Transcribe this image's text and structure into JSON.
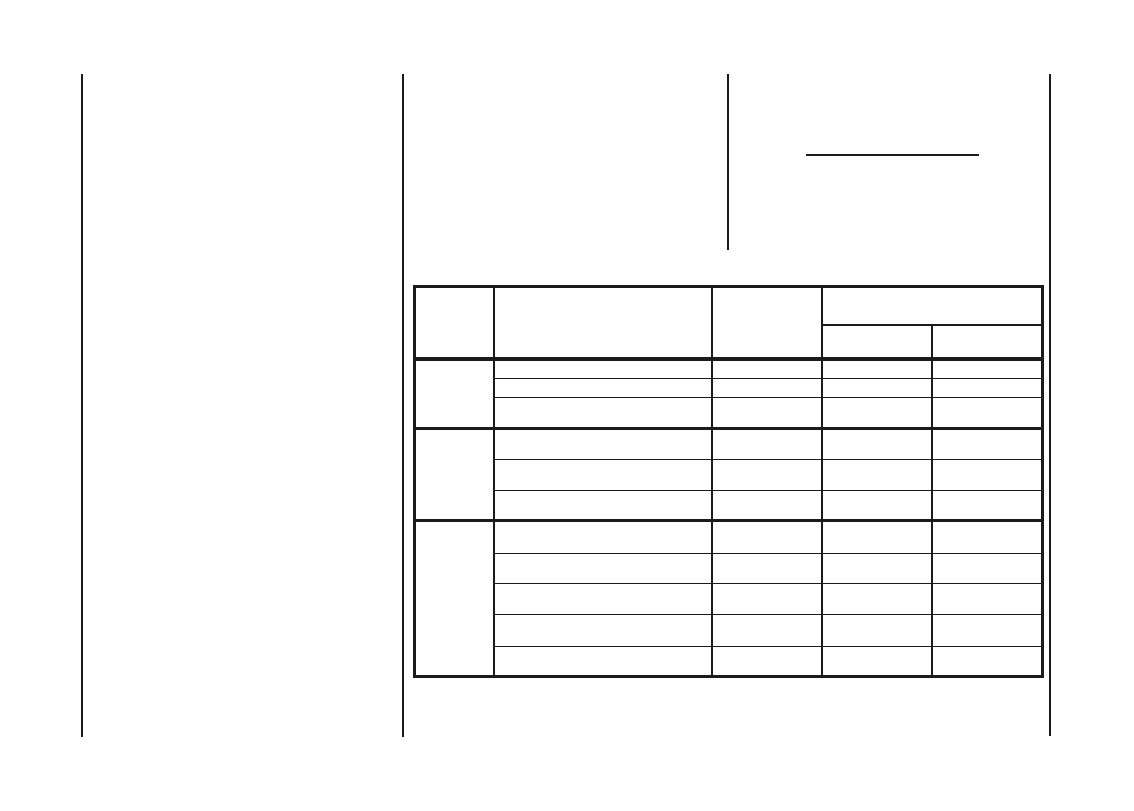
{
  "colors": {
    "background": "#ffffff",
    "ink": "#1d1a1b"
  },
  "blank_line": {
    "text": ""
  },
  "table": {
    "header": {
      "col1": "",
      "col2": "",
      "col3": "",
      "col4_group": "",
      "col4_sub1": "",
      "col4_sub2": ""
    },
    "groups": [
      {
        "label": "",
        "rows": [
          [
            "",
            "",
            "",
            ""
          ],
          [
            "",
            "",
            "",
            ""
          ],
          [
            "",
            "",
            "",
            ""
          ]
        ]
      },
      {
        "label": "",
        "rows": [
          [
            "",
            "",
            "",
            ""
          ],
          [
            "",
            "",
            "",
            ""
          ],
          [
            "",
            "",
            "",
            ""
          ]
        ]
      },
      {
        "label": "",
        "rows": [
          [
            "",
            "",
            "",
            ""
          ],
          [
            "",
            "",
            "",
            ""
          ],
          [
            "",
            "",
            "",
            ""
          ],
          [
            "",
            "",
            "",
            ""
          ],
          [
            "",
            "",
            "",
            ""
          ]
        ]
      }
    ]
  }
}
